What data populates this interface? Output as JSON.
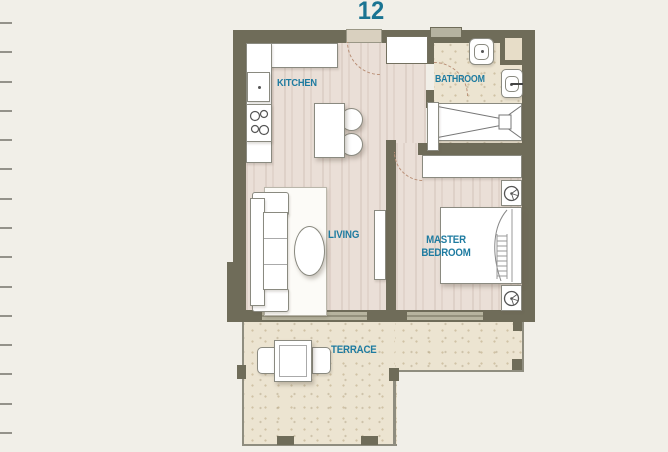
{
  "header": {
    "unit_number": "12"
  },
  "rooms": {
    "kitchen": {
      "label": "KITCHEN"
    },
    "bathroom": {
      "label": "BATHROOM"
    },
    "living": {
      "label": "LIVING"
    },
    "master_bedroom": {
      "label": "MASTER BEDROOM"
    },
    "terrace": {
      "label": "TERRACE"
    }
  },
  "colors": {
    "page_background": "#f1efe8",
    "wall": "#6f6c59",
    "wood_floor": "#eadfd7",
    "terrace_floor": "#ece4d1",
    "label_accent": "#1e7ba0",
    "unit_number_accent": "#1a7492"
  },
  "ruler": {
    "tick_count": 15
  }
}
